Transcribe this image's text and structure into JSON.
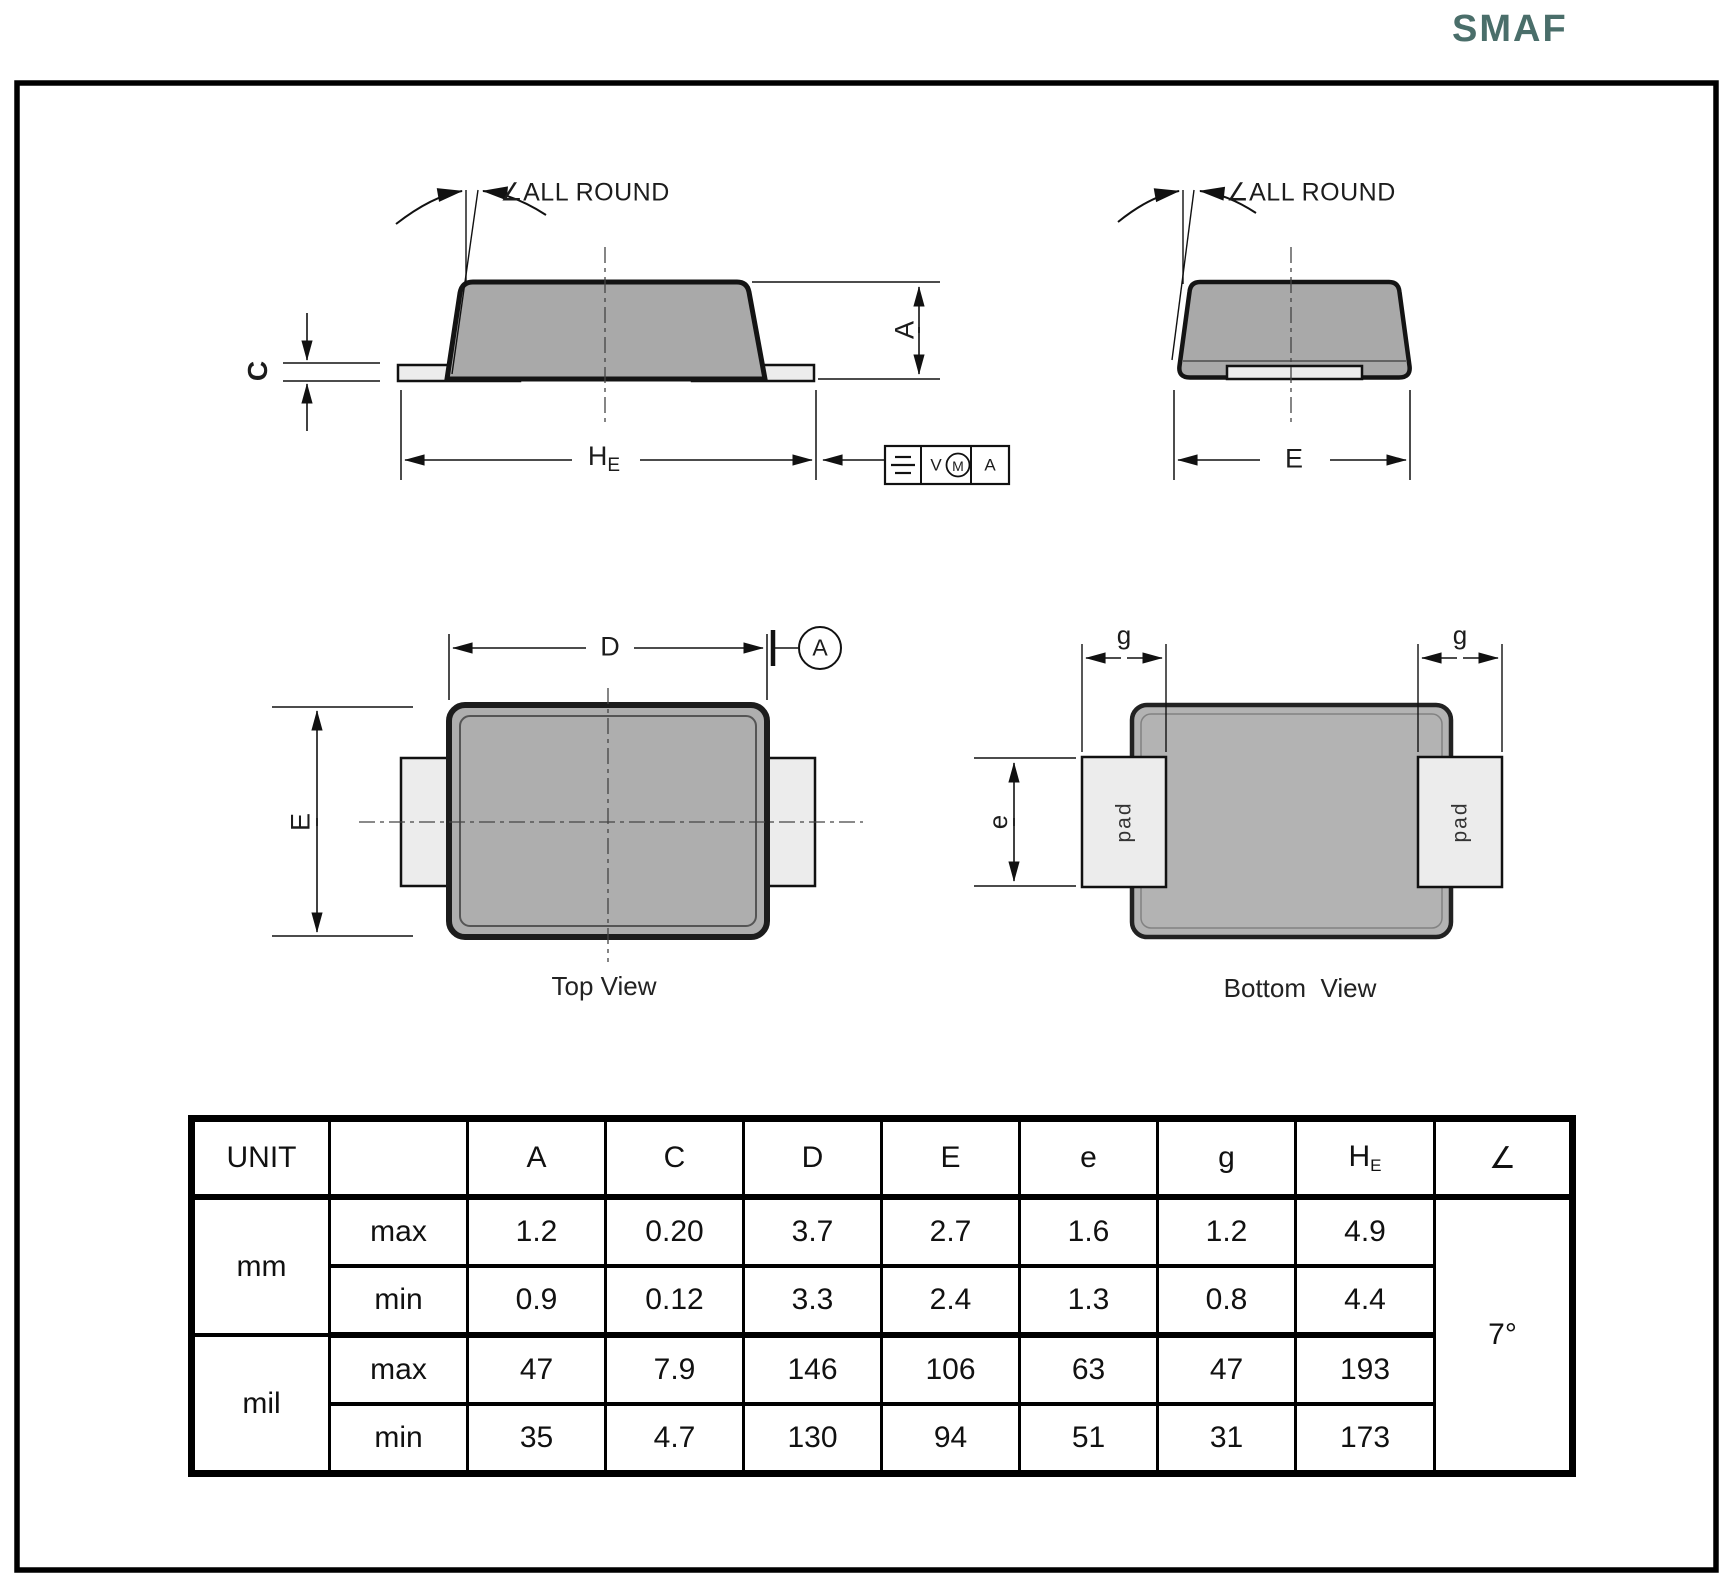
{
  "page": {
    "title": "SMAF"
  },
  "side_view": {
    "angle_note": "∠ALL ROUND",
    "dim_c": "C",
    "dim_a": "A",
    "dim_h": "H",
    "dim_h_sub": "E",
    "fcf_tolerance": "V",
    "fcf_modifier": "M",
    "fcf_datum": "A",
    "fcf_symbol_icon": "symmetry-icon"
  },
  "end_view": {
    "angle_note": "∠ALL ROUND",
    "dim_e": "E"
  },
  "top_view": {
    "dim_d": "D",
    "datum": "A",
    "dim_e": "E",
    "caption": "Top View"
  },
  "bottom_view": {
    "dim_g_left": "g",
    "dim_g_right": "g",
    "dim_e": "e",
    "pad_left": "pad",
    "pad_right": "pad",
    "caption": "Bottom  View"
  },
  "table": {
    "unit_header": "UNIT",
    "col_A": "A",
    "col_C": "C",
    "col_D": "D",
    "col_E": "E",
    "col_e": "e",
    "col_g": "g",
    "col_H": "H",
    "col_H_sub": "E",
    "col_angle": "∠",
    "unit_mm": "mm",
    "unit_mil": "mil",
    "limit_max_mm": "max",
    "limit_min_mm": "min",
    "limit_max_mil": "max",
    "limit_min_mil": "min",
    "mm_max": [
      "1.2",
      "0.20",
      "3.7",
      "2.7",
      "1.6",
      "1.2",
      "4.9"
    ],
    "mm_min": [
      "0.9",
      "0.12",
      "3.3",
      "2.4",
      "1.3",
      "0.8",
      "4.4"
    ],
    "mil_max": [
      "47",
      "7.9",
      "146",
      "106",
      "63",
      "47",
      "193"
    ],
    "mil_min": [
      "35",
      "4.7",
      "130",
      "94",
      "51",
      "31",
      "173"
    ],
    "angle_value": "7°"
  },
  "colors": {
    "title": "#4a6e6a",
    "body_fill": "#a9a9a9",
    "lead_fill": "#ececec",
    "outline": "#141414"
  }
}
